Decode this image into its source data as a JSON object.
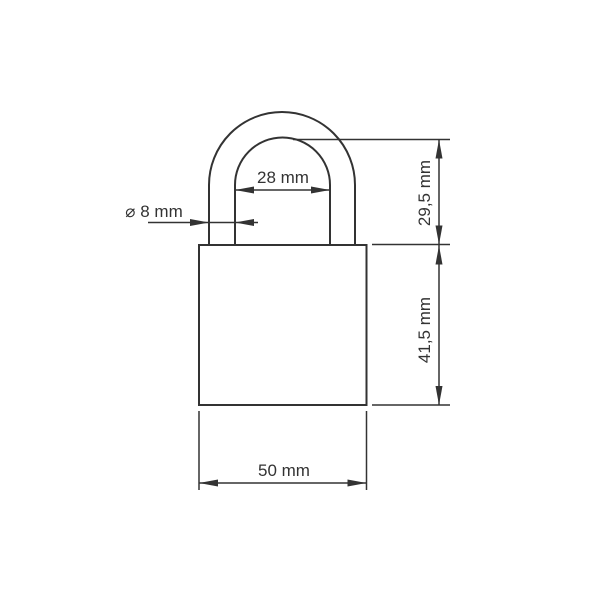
{
  "drawing": {
    "subject": "padlock-dimension-drawing",
    "background_color": "#ffffff",
    "line_color": "#333333",
    "labels": {
      "shackle_inner_width": "28 mm",
      "shackle_diameter": "⌀ 8 mm",
      "shackle_height": "29,5 mm",
      "body_height": "41,5 mm",
      "body_width": "50 mm"
    }
  }
}
